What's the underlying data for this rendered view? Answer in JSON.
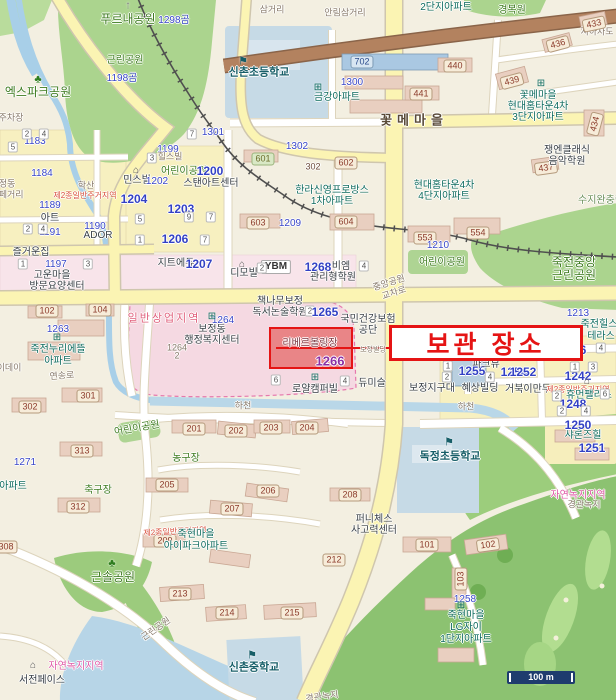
{
  "annotation": {
    "text": "보관 장소",
    "color": "#e51414",
    "highlight_block_number": "1266"
  },
  "scale": {
    "text": "100 m"
  },
  "colors": {
    "park": "#abd48e",
    "water": "#b7d5e7",
    "road_major": "#fbf4b3",
    "commercial_zone": "#f5d9e2",
    "highlight_fill": "#e46a6a",
    "annotation_red": "#e51414"
  },
  "labels": [
    {
      "t": "푸르내공원",
      "x": 128,
      "y": 19,
      "c": "pkb"
    },
    {
      "t": "1298곰",
      "x": 174,
      "y": 21,
      "c": "nb"
    },
    {
      "t": "근린공원",
      "x": 125,
      "y": 61,
      "c": "pk"
    },
    {
      "t": "1198곰",
      "x": 122,
      "y": 79,
      "c": "nb"
    },
    {
      "t": "엑스파크공원",
      "x": 38,
      "y": 92,
      "c": "pkb"
    },
    {
      "t": "삼거리",
      "x": 272,
      "y": 10,
      "c": "gr"
    },
    {
      "t": "안림삼거리",
      "x": 345,
      "y": 13,
      "c": "gr"
    },
    {
      "t": "경복원",
      "x": 512,
      "y": 11,
      "c": "pk"
    },
    {
      "t": "2단지아파트",
      "x": 446,
      "y": 8,
      "c": "ap"
    },
    {
      "t": "지하차도",
      "x": 597,
      "y": 32,
      "c": "gr"
    },
    {
      "t": "신촌초등학교",
      "x": 259,
      "y": 73,
      "c": "sc"
    },
    {
      "t": "금강아파트",
      "x": 337,
      "y": 98,
      "c": "ap"
    },
    {
      "t": "1300",
      "x": 352,
      "y": 83,
      "c": "nb"
    },
    {
      "t": "702",
      "x": 362,
      "y": 62,
      "c": "bxb"
    },
    {
      "t": "433",
      "x": 594,
      "y": 24,
      "c": "bx",
      "r": -12
    },
    {
      "t": "436",
      "x": 558,
      "y": 44,
      "c": "bx",
      "r": -15
    },
    {
      "t": "440",
      "x": 455,
      "y": 66,
      "c": "bx"
    },
    {
      "t": "441",
      "x": 421,
      "y": 94,
      "c": "bx"
    },
    {
      "t": "439",
      "x": 512,
      "y": 81,
      "c": "bx",
      "r": -15
    },
    {
      "t": "434",
      "x": 595,
      "y": 124,
      "c": "bx",
      "r": -75
    },
    {
      "t": "437",
      "x": 546,
      "y": 168,
      "c": "bx",
      "r": -8
    },
    {
      "t": "꽃메마을",
      "x": 538,
      "y": 96,
      "c": "ap"
    },
    {
      "t": "현대홈타운4차",
      "x": 538,
      "y": 107,
      "c": "ap"
    },
    {
      "t": "3단지아파트",
      "x": 538,
      "y": 118,
      "c": "ap"
    },
    {
      "t": "꽃메마을",
      "x": 414,
      "y": 120,
      "c": "rb"
    },
    {
      "t": "쟁엔클래식",
      "x": 567,
      "y": 151,
      "c": "po"
    },
    {
      "t": "음악학원",
      "x": 567,
      "y": 162,
      "c": "po"
    },
    {
      "t": "주차장",
      "x": 11,
      "y": 118,
      "c": "gr"
    },
    {
      "t": "1183",
      "x": 35,
      "y": 142,
      "c": "nb"
    },
    {
      "t": "1184",
      "x": 42,
      "y": 174,
      "c": "nb"
    },
    {
      "t": "보정동",
      "x": 3,
      "y": 184,
      "c": "gr"
    },
    {
      "t": "카페거리",
      "x": 7,
      "y": 195,
      "c": "gr"
    },
    {
      "t": "학산",
      "x": 86,
      "y": 186,
      "c": "gr"
    },
    {
      "t": "제2종일반주거지역",
      "x": 85,
      "y": 196,
      "c": "zr"
    },
    {
      "t": "1189",
      "x": 50,
      "y": 206,
      "c": "nb"
    },
    {
      "t": "아트",
      "x": 50,
      "y": 219,
      "c": "po"
    },
    {
      "t": "1191",
      "x": 50,
      "y": 233,
      "c": "nb"
    },
    {
      "t": "1190",
      "x": 95,
      "y": 227,
      "c": "nb"
    },
    {
      "t": "ADOR",
      "x": 98,
      "y": 236,
      "c": "po"
    },
    {
      "t": "즐거운집",
      "x": 31,
      "y": 253,
      "c": "po"
    },
    {
      "t": "1197",
      "x": 56,
      "y": 265,
      "c": "nb"
    },
    {
      "t": "고운마을",
      "x": 52,
      "y": 276,
      "c": "po"
    },
    {
      "t": "방문요양센터",
      "x": 57,
      "y": 287,
      "c": "po"
    },
    {
      "t": "1199",
      "x": 168,
      "y": 150,
      "c": "nb"
    },
    {
      "t": "힐스빌",
      "x": 170,
      "y": 157,
      "c": "gr"
    },
    {
      "t": "민스빌",
      "x": 137,
      "y": 181,
      "c": "po"
    },
    {
      "t": "1202",
      "x": 157,
      "y": 182,
      "c": "nb"
    },
    {
      "t": "어린이공원",
      "x": 184,
      "y": 172,
      "c": "pk"
    },
    {
      "t": "1200",
      "x": 210,
      "y": 171,
      "c": "nbb"
    },
    {
      "t": "스탠아트센터",
      "x": 211,
      "y": 184,
      "c": "po"
    },
    {
      "t": "1204",
      "x": 134,
      "y": 199,
      "c": "nbb"
    },
    {
      "t": "1203",
      "x": 181,
      "y": 209,
      "c": "nbb"
    },
    {
      "t": "1206",
      "x": 175,
      "y": 239,
      "c": "nbb"
    },
    {
      "t": "지트에듀",
      "x": 176,
      "y": 264,
      "c": "po"
    },
    {
      "t": "1207",
      "x": 199,
      "y": 264,
      "c": "nbb"
    },
    {
      "t": "디모빌",
      "x": 244,
      "y": 274,
      "c": "po"
    },
    {
      "t": "YBM",
      "x": 276,
      "y": 267,
      "c": "bxw"
    },
    {
      "t": "1268",
      "x": 318,
      "y": 267,
      "c": "nbb"
    },
    {
      "t": "비엠",
      "x": 341,
      "y": 267,
      "c": "po"
    },
    {
      "t": "관리형학원",
      "x": 333,
      "y": 278,
      "c": "po"
    },
    {
      "t": "1301",
      "x": 213,
      "y": 133,
      "c": "nb"
    },
    {
      "t": "1302",
      "x": 297,
      "y": 147,
      "c": "nb"
    },
    {
      "t": "302",
      "x": 313,
      "y": 167,
      "c": "bn"
    },
    {
      "t": "602",
      "x": 346,
      "y": 163,
      "c": "bx"
    },
    {
      "t": "601",
      "x": 263,
      "y": 159,
      "c": "bxg"
    },
    {
      "t": "603",
      "x": 258,
      "y": 223,
      "c": "bx"
    },
    {
      "t": "1209",
      "x": 290,
      "y": 224,
      "c": "nb"
    },
    {
      "t": "604",
      "x": 346,
      "y": 222,
      "c": "bx"
    },
    {
      "t": "한라신영프로방스",
      "x": 332,
      "y": 191,
      "c": "ap"
    },
    {
      "t": "1차아파트",
      "x": 332,
      "y": 202,
      "c": "ap"
    },
    {
      "t": "현대홈타운4차",
      "x": 444,
      "y": 186,
      "c": "ap"
    },
    {
      "t": "4단지아파트",
      "x": 444,
      "y": 197,
      "c": "ap"
    },
    {
      "t": "553",
      "x": 425,
      "y": 238,
      "c": "bx"
    },
    {
      "t": "554",
      "x": 478,
      "y": 233,
      "c": "bx"
    },
    {
      "t": "1210",
      "x": 438,
      "y": 246,
      "c": "nb"
    },
    {
      "t": "어린이공원",
      "x": 442,
      "y": 263,
      "c": "pk"
    },
    {
      "t": "죽전중앙",
      "x": 574,
      "y": 262,
      "c": "pkb"
    },
    {
      "t": "근린공원",
      "x": 574,
      "y": 275,
      "c": "pkb"
    },
    {
      "t": "수지완충림",
      "x": 601,
      "y": 201,
      "c": "gz"
    },
    {
      "t": "중앙공원",
      "x": 389,
      "y": 283,
      "c": "gr",
      "r": -18
    },
    {
      "t": "교차로",
      "x": 394,
      "y": 293,
      "c": "gr",
      "r": -18
    },
    {
      "t": "일반상업지역",
      "x": 164,
      "y": 319,
      "c": "zc"
    },
    {
      "t": "보정동",
      "x": 212,
      "y": 330,
      "c": "po"
    },
    {
      "t": "행정복지센터",
      "x": 212,
      "y": 341,
      "c": "po"
    },
    {
      "t": "1264",
      "x": 223,
      "y": 321,
      "c": "nb"
    },
    {
      "t": "1264",
      "x": 177,
      "y": 348,
      "c": "gr"
    },
    {
      "t": "2",
      "x": 177,
      "y": 356,
      "c": "gr"
    },
    {
      "t": "102",
      "x": 47,
      "y": 311,
      "c": "bx"
    },
    {
      "t": "104",
      "x": 100,
      "y": 310,
      "c": "bx"
    },
    {
      "t": "1263",
      "x": 58,
      "y": 330,
      "c": "nb"
    },
    {
      "t": "죽전누리에뜰",
      "x": 58,
      "y": 350,
      "c": "ap"
    },
    {
      "t": "아파트",
      "x": 58,
      "y": 362,
      "c": "ap"
    },
    {
      "t": "이데이",
      "x": 9,
      "y": 368,
      "c": "gr"
    },
    {
      "t": "연송로",
      "x": 62,
      "y": 376,
      "c": "gr",
      "r": -4
    },
    {
      "t": "301",
      "x": 88,
      "y": 396,
      "c": "bx"
    },
    {
      "t": "302",
      "x": 30,
      "y": 407,
      "c": "bx"
    },
    {
      "t": "책나무보정",
      "x": 280,
      "y": 302,
      "c": "po"
    },
    {
      "t": "독서논술학원",
      "x": 280,
      "y": 313,
      "c": "po"
    },
    {
      "t": "2",
      "x": 310,
      "y": 311,
      "c": "dg"
    },
    {
      "t": "1265",
      "x": 325,
      "y": 312,
      "c": "nbb"
    },
    {
      "t": "국민건강보험",
      "x": 368,
      "y": 320,
      "c": "po"
    },
    {
      "t": "공단",
      "x": 368,
      "y": 331,
      "c": "po"
    },
    {
      "t": "리베르볼링장",
      "x": 310,
      "y": 344,
      "c": "pr"
    },
    {
      "t": "1266",
      "x": 330,
      "y": 361,
      "c": "npu"
    },
    {
      "t": "보정빌딩",
      "x": 373,
      "y": 350,
      "c": "gr",
      "s": 7
    },
    {
      "t": "6",
      "x": 276,
      "y": 380,
      "c": "dg"
    },
    {
      "t": "4",
      "x": 345,
      "y": 381,
      "c": "dg"
    },
    {
      "t": "로얄캠퍼빌",
      "x": 315,
      "y": 390,
      "c": "po"
    },
    {
      "t": "듀미슬",
      "x": 372,
      "y": 384,
      "c": "po"
    },
    {
      "t": "보정지구대",
      "x": 432,
      "y": 389,
      "c": "po"
    },
    {
      "t": "1255",
      "x": 472,
      "y": 371,
      "c": "nbb"
    },
    {
      "t": "1254",
      "x": 514,
      "y": 372,
      "c": "nbb"
    },
    {
      "t": "1",
      "x": 448,
      "y": 366,
      "c": "dg"
    },
    {
      "t": "2",
      "x": 447,
      "y": 377,
      "c": "dg"
    },
    {
      "t": "혜상빌딩",
      "x": 480,
      "y": 389,
      "c": "po"
    },
    {
      "t": "4",
      "x": 490,
      "y": 377,
      "c": "dg"
    },
    {
      "t": "거북이만두",
      "x": 528,
      "y": 390,
      "c": "po"
    },
    {
      "t": "파크뷰",
      "x": 486,
      "y": 365,
      "c": "po"
    },
    {
      "t": "1252",
      "x": 523,
      "y": 372,
      "c": "nbb"
    },
    {
      "t": "샤인힐",
      "x": 560,
      "y": 357,
      "c": "ap"
    },
    {
      "t": "1246",
      "x": 573,
      "y": 350,
      "c": "nbb"
    },
    {
      "t": "1213",
      "x": 578,
      "y": 314,
      "c": "nb"
    },
    {
      "t": "죽전힐스",
      "x": 599,
      "y": 325,
      "c": "ap"
    },
    {
      "t": "테라스",
      "x": 601,
      "y": 337,
      "c": "ap"
    },
    {
      "t": "1242",
      "x": 578,
      "y": 376,
      "c": "nbb"
    },
    {
      "t": "1",
      "x": 575,
      "y": 367,
      "c": "dg"
    },
    {
      "t": "3",
      "x": 593,
      "y": 367,
      "c": "dg"
    },
    {
      "t": "제2종일반주거지역",
      "x": 578,
      "y": 390,
      "c": "zr"
    },
    {
      "t": "휴먼팰리스",
      "x": 589,
      "y": 396,
      "c": "ap"
    },
    {
      "t": "1248",
      "x": 573,
      "y": 404,
      "c": "nbb"
    },
    {
      "t": "2",
      "x": 562,
      "y": 411,
      "c": "dg"
    },
    {
      "t": "4",
      "x": 586,
      "y": 411,
      "c": "dg"
    },
    {
      "t": "2",
      "x": 557,
      "y": 396,
      "c": "dg"
    },
    {
      "t": "6",
      "x": 605,
      "y": 394,
      "c": "dg"
    },
    {
      "t": "1",
      "x": 530,
      "y": 350,
      "c": "dg"
    },
    {
      "t": "1",
      "x": 497,
      "y": 345,
      "c": "dg"
    },
    {
      "t": "4",
      "x": 601,
      "y": 348,
      "c": "dg"
    },
    {
      "t": "하천",
      "x": 243,
      "y": 406,
      "c": "gr"
    },
    {
      "t": "하천",
      "x": 466,
      "y": 407,
      "c": "gr"
    },
    {
      "t": "201",
      "x": 194,
      "y": 429,
      "c": "bx"
    },
    {
      "t": "202",
      "x": 236,
      "y": 431,
      "c": "bx"
    },
    {
      "t": "203",
      "x": 271,
      "y": 428,
      "c": "bx"
    },
    {
      "t": "204",
      "x": 307,
      "y": 428,
      "c": "bx"
    },
    {
      "t": "어린이공원",
      "x": 137,
      "y": 429,
      "c": "pk",
      "r": -10
    },
    {
      "t": "313",
      "x": 82,
      "y": 451,
      "c": "bx"
    },
    {
      "t": "1271",
      "x": 25,
      "y": 463,
      "c": "nb"
    },
    {
      "t": "아파트",
      "x": 13,
      "y": 487,
      "c": "ap"
    },
    {
      "t": "312",
      "x": 78,
      "y": 507,
      "c": "bx"
    },
    {
      "t": "308",
      "x": 6,
      "y": 547,
      "c": "bx"
    },
    {
      "t": "농구장",
      "x": 186,
      "y": 459,
      "c": "pk"
    },
    {
      "t": "축구장",
      "x": 98,
      "y": 491,
      "c": "pk"
    },
    {
      "t": "205",
      "x": 167,
      "y": 485,
      "c": "bx"
    },
    {
      "t": "206",
      "x": 268,
      "y": 491,
      "c": "bx"
    },
    {
      "t": "207",
      "x": 232,
      "y": 509,
      "c": "bx"
    },
    {
      "t": "208",
      "x": 350,
      "y": 495,
      "c": "bx"
    },
    {
      "t": "209",
      "x": 165,
      "y": 541,
      "c": "bx"
    },
    {
      "t": "212",
      "x": 334,
      "y": 560,
      "c": "bx"
    },
    {
      "t": "제2종일반주거지역",
      "x": 175,
      "y": 532,
      "c": "zr",
      "r": -3
    },
    {
      "t": "죽현마을",
      "x": 196,
      "y": 535,
      "c": "ap"
    },
    {
      "t": "아이파크아파트",
      "x": 196,
      "y": 547,
      "c": "ap"
    },
    {
      "t": "퍼니체스",
      "x": 374,
      "y": 520,
      "c": "po"
    },
    {
      "t": "사고력센터",
      "x": 374,
      "y": 531,
      "c": "po"
    },
    {
      "t": "독정초등학교",
      "x": 450,
      "y": 457,
      "c": "sc"
    },
    {
      "t": "101",
      "x": 427,
      "y": 545,
      "c": "bx"
    },
    {
      "t": "102",
      "x": 488,
      "y": 545,
      "c": "bx",
      "r": -8
    },
    {
      "t": "103",
      "x": 461,
      "y": 579,
      "c": "bx",
      "r": -90
    },
    {
      "t": "자연녹지지역",
      "x": 578,
      "y": 496,
      "c": "zg"
    },
    {
      "t": "경관녹지",
      "x": 584,
      "y": 505,
      "c": "gr"
    },
    {
      "t": "샤론즈힐",
      "x": 583,
      "y": 436,
      "c": "ap"
    },
    {
      "t": "1250",
      "x": 578,
      "y": 425,
      "c": "nbb"
    },
    {
      "t": "1251",
      "x": 592,
      "y": 448,
      "c": "nbb"
    },
    {
      "t": "근솔공원",
      "x": 113,
      "y": 577,
      "c": "pkb"
    },
    {
      "t": "근린공원",
      "x": 156,
      "y": 629,
      "c": "gr",
      "r": -35
    },
    {
      "t": "213",
      "x": 180,
      "y": 594,
      "c": "bx"
    },
    {
      "t": "214",
      "x": 227,
      "y": 613,
      "c": "bx"
    },
    {
      "t": "215",
      "x": 292,
      "y": 613,
      "c": "bx"
    },
    {
      "t": "신촌중학교",
      "x": 254,
      "y": 668,
      "c": "sc"
    },
    {
      "t": "죽현마을",
      "x": 466,
      "y": 616,
      "c": "ap"
    },
    {
      "t": "LG자이",
      "x": 466,
      "y": 628,
      "c": "ap"
    },
    {
      "t": "1단지아파트",
      "x": 466,
      "y": 640,
      "c": "ap"
    },
    {
      "t": "1258",
      "x": 465,
      "y": 600,
      "c": "nb"
    },
    {
      "t": "자연녹지지역",
      "x": 76,
      "y": 667,
      "c": "zg"
    },
    {
      "t": "서전페이스",
      "x": 42,
      "y": 681,
      "c": "po"
    },
    {
      "t": "경관녹지",
      "x": 322,
      "y": 697,
      "c": "gr",
      "r": -8
    },
    {
      "t": "2",
      "x": 27,
      "y": 134,
      "c": "dg"
    },
    {
      "t": "4",
      "x": 44,
      "y": 134,
      "c": "dg"
    },
    {
      "t": "5",
      "x": 13,
      "y": 147,
      "c": "dg"
    },
    {
      "t": "2",
      "x": 28,
      "y": 229,
      "c": "dg"
    },
    {
      "t": "4",
      "x": 43,
      "y": 229,
      "c": "dg"
    },
    {
      "t": "1",
      "x": 23,
      "y": 264,
      "c": "dg"
    },
    {
      "t": "3",
      "x": 88,
      "y": 264,
      "c": "dg"
    },
    {
      "t": "3",
      "x": 152,
      "y": 158,
      "c": "dg"
    },
    {
      "t": "7",
      "x": 192,
      "y": 134,
      "c": "dg"
    },
    {
      "t": "5",
      "x": 140,
      "y": 219,
      "c": "dg"
    },
    {
      "t": "9",
      "x": 189,
      "y": 217,
      "c": "dg"
    },
    {
      "t": "7",
      "x": 211,
      "y": 217,
      "c": "dg"
    },
    {
      "t": "1",
      "x": 140,
      "y": 240,
      "c": "dg"
    },
    {
      "t": "7",
      "x": 205,
      "y": 240,
      "c": "dg"
    },
    {
      "t": "2",
      "x": 262,
      "y": 268,
      "c": "dg"
    },
    {
      "t": "4",
      "x": 364,
      "y": 266,
      "c": "dg"
    }
  ],
  "icons": [
    {
      "n": "up-arrow-icon",
      "g": "↑",
      "x": 128,
      "y": 6,
      "c": "icg"
    },
    {
      "n": "tree-icon",
      "g": "♣",
      "x": 38,
      "y": 80,
      "c": "ict"
    },
    {
      "n": "tree-icon",
      "g": "♣",
      "x": 112,
      "y": 564,
      "c": "ict"
    },
    {
      "n": "school-icon",
      "g": "⚑",
      "x": 243,
      "y": 62,
      "c": "ics"
    },
    {
      "n": "school-icon",
      "g": "⚑",
      "x": 449,
      "y": 443,
      "c": "ics"
    },
    {
      "n": "school-icon",
      "g": "⚑",
      "x": 252,
      "y": 656,
      "c": "ics"
    },
    {
      "n": "apartment-icon",
      "g": "⊞",
      "x": 318,
      "y": 88,
      "c": "ica"
    },
    {
      "n": "apartment-icon",
      "g": "⊞",
      "x": 541,
      "y": 84,
      "c": "ica"
    },
    {
      "n": "apartment-icon",
      "g": "⊞",
      "x": 57,
      "y": 338,
      "c": "ica"
    },
    {
      "n": "apartment-icon",
      "g": "⊞",
      "x": 212,
      "y": 317,
      "c": "ica"
    },
    {
      "n": "apartment-icon",
      "g": "⊞",
      "x": 315,
      "y": 378,
      "c": "ica"
    },
    {
      "n": "apartment-icon",
      "g": "⊞",
      "x": 461,
      "y": 606,
      "c": "ica"
    },
    {
      "n": "apartment-icon",
      "g": "⊞",
      "x": 560,
      "y": 344,
      "c": "ica"
    },
    {
      "n": "building-icon",
      "g": "⌂",
      "x": 136,
      "y": 171,
      "c": "icb"
    },
    {
      "n": "building-icon",
      "g": "⌂",
      "x": 242,
      "y": 265,
      "c": "icb"
    },
    {
      "n": "building-icon",
      "g": "⌂",
      "x": 484,
      "y": 356,
      "c": "icb"
    },
    {
      "n": "building-icon",
      "g": "⌂",
      "x": 587,
      "y": 382,
      "c": "icb"
    },
    {
      "n": "building-icon",
      "g": "⌂",
      "x": 33,
      "y": 666,
      "c": "icb"
    }
  ]
}
